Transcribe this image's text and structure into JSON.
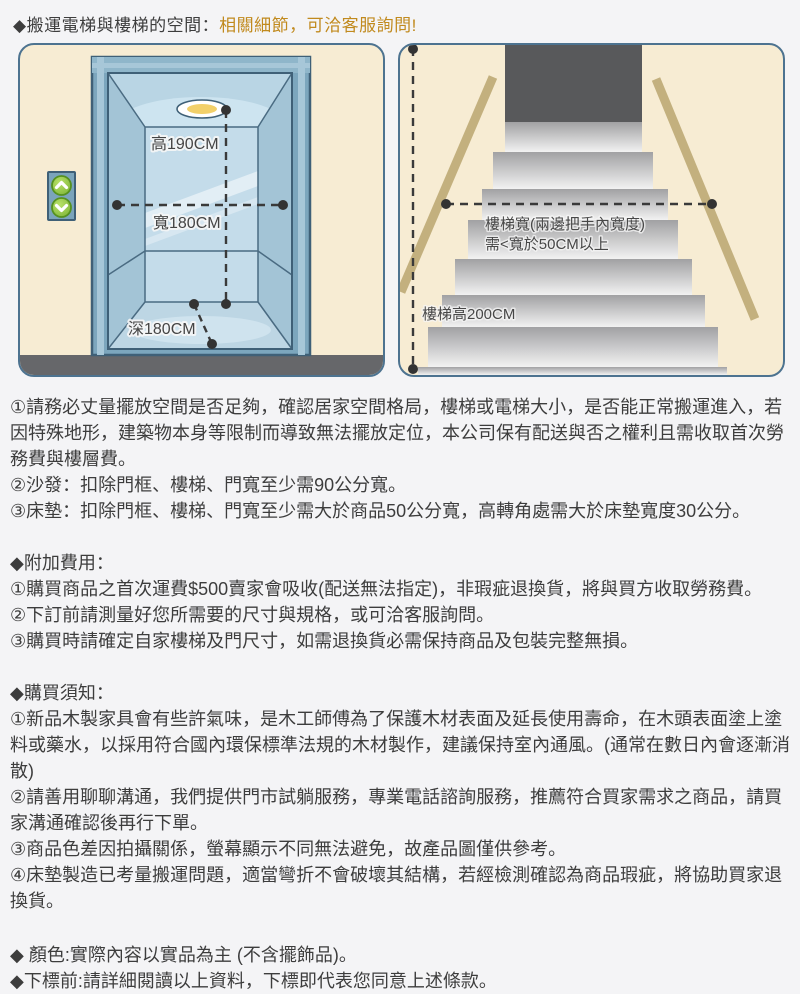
{
  "colors": {
    "page_bg": "#f4f4f6",
    "accent_gold": "#c18a1e",
    "panel_bg": "#f7ecd3",
    "panel_border": "#4d7390",
    "elevator_frame_blue": "#7ca6bd",
    "handrail_tan": "#c3b07e",
    "floor_gray": "#66676a",
    "text": "#3d3d3d"
  },
  "header": {
    "prefix": "◆搬運電梯與樓梯的空間：",
    "highlight": "相關細節，可洽客服詢問!"
  },
  "elevator_diagram": {
    "height_label": "高190CM",
    "width_label": "寬180CM",
    "depth_label": "深180CM",
    "icons": [
      "elevator-up-button",
      "elevator-down-button",
      "ceiling-light"
    ]
  },
  "stairs_diagram": {
    "width_label_line1": "樓梯寬(兩邊把手內寬度)",
    "width_label_line2": "需<寬於50CM以上",
    "height_label": "樓梯高200CM"
  },
  "sections": {
    "space": {
      "items": [
        "①請務必丈量擺放空間是否足夠，確認居家空間格局，樓梯或電梯大小，是否能正常搬運進入，若因特殊地形，建築物本身等限制而導致無法擺放定位，本公司保有配送與否之權利且需收取首次勞務費與樓層費。",
        "②沙發：扣除門框、樓梯、門寬至少需90公分寬。",
        "③床墊：扣除門框、樓梯、門寬至少需大於商品50公分寬，高轉角處需大於床墊寬度30公分。"
      ]
    },
    "fees": {
      "title": "◆附加費用：",
      "items": [
        "①購買商品之首次運費$500賣家會吸收(配送無法指定)，非瑕疵退換貨，將與買方收取勞務費。",
        "②下訂前請測量好您所需要的尺寸與規格，或可洽客服詢問。",
        "③購買時請確定自家樓梯及門尺寸，如需退換貨必需保持商品及包裝完整無損。"
      ]
    },
    "notice": {
      "title": "◆購買須知：",
      "items": [
        "①新品木製家具會有些許氣味，是木工師傅為了保護木材表面及延長使用壽命，在木頭表面塗上塗料或藥水，以採用符合國內環保標準法規的木材製作，建議保持室內通風。(通常在數日內會逐漸消散)",
        "②請善用聊聊溝通，我們提供門市試躺服務，專業電話諮詢服務，推薦符合買家需求之商品，請買家溝通確認後再行下單。",
        "③商品色差因拍攝關係，螢幕顯示不同無法避免，故產品圖僅供參考。",
        "④床墊製造已考量搬運問題，適當彎折不會破壞其結構，若經檢測確認為商品瑕疵，將協助買家退換貨。"
      ]
    },
    "footer": {
      "items": [
        "◆ 顏色:實際內容以實品為主 (不含擺飾品)。",
        "◆下標前:請詳細閱讀以上資料，下標即代表您同意上述條款。"
      ]
    }
  }
}
